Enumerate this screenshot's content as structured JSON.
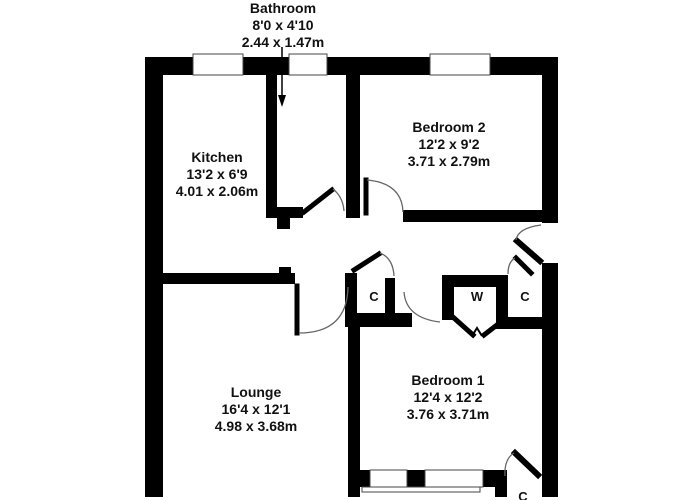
{
  "plan": {
    "rooms": {
      "bathroom": {
        "name": "Bathroom",
        "imperial": "8'0 x 4'10",
        "metric": "2.44 x 1.47m"
      },
      "kitchen": {
        "name": "Kitchen",
        "imperial": "13'2 x 6'9",
        "metric": "4.01 x 2.06m"
      },
      "bedroom2": {
        "name": "Bedroom 2",
        "imperial": "12'2 x 9'2",
        "metric": "3.71 x 2.79m"
      },
      "lounge": {
        "name": "Lounge",
        "imperial": "16'4 x 12'1",
        "metric": "4.98 x 3.68m"
      },
      "bedroom1": {
        "name": "Bedroom 1",
        "imperial": "12'4 x 12'2",
        "metric": "3.76 x 3.71m"
      }
    },
    "closets": {
      "hall_closet_left": "C",
      "wardrobe": "W",
      "hall_closet_right": "C",
      "bedroom1_closet": "C"
    },
    "colors": {
      "wall": "#000000",
      "background": "#ffffff",
      "door_swing": "#666666"
    }
  }
}
